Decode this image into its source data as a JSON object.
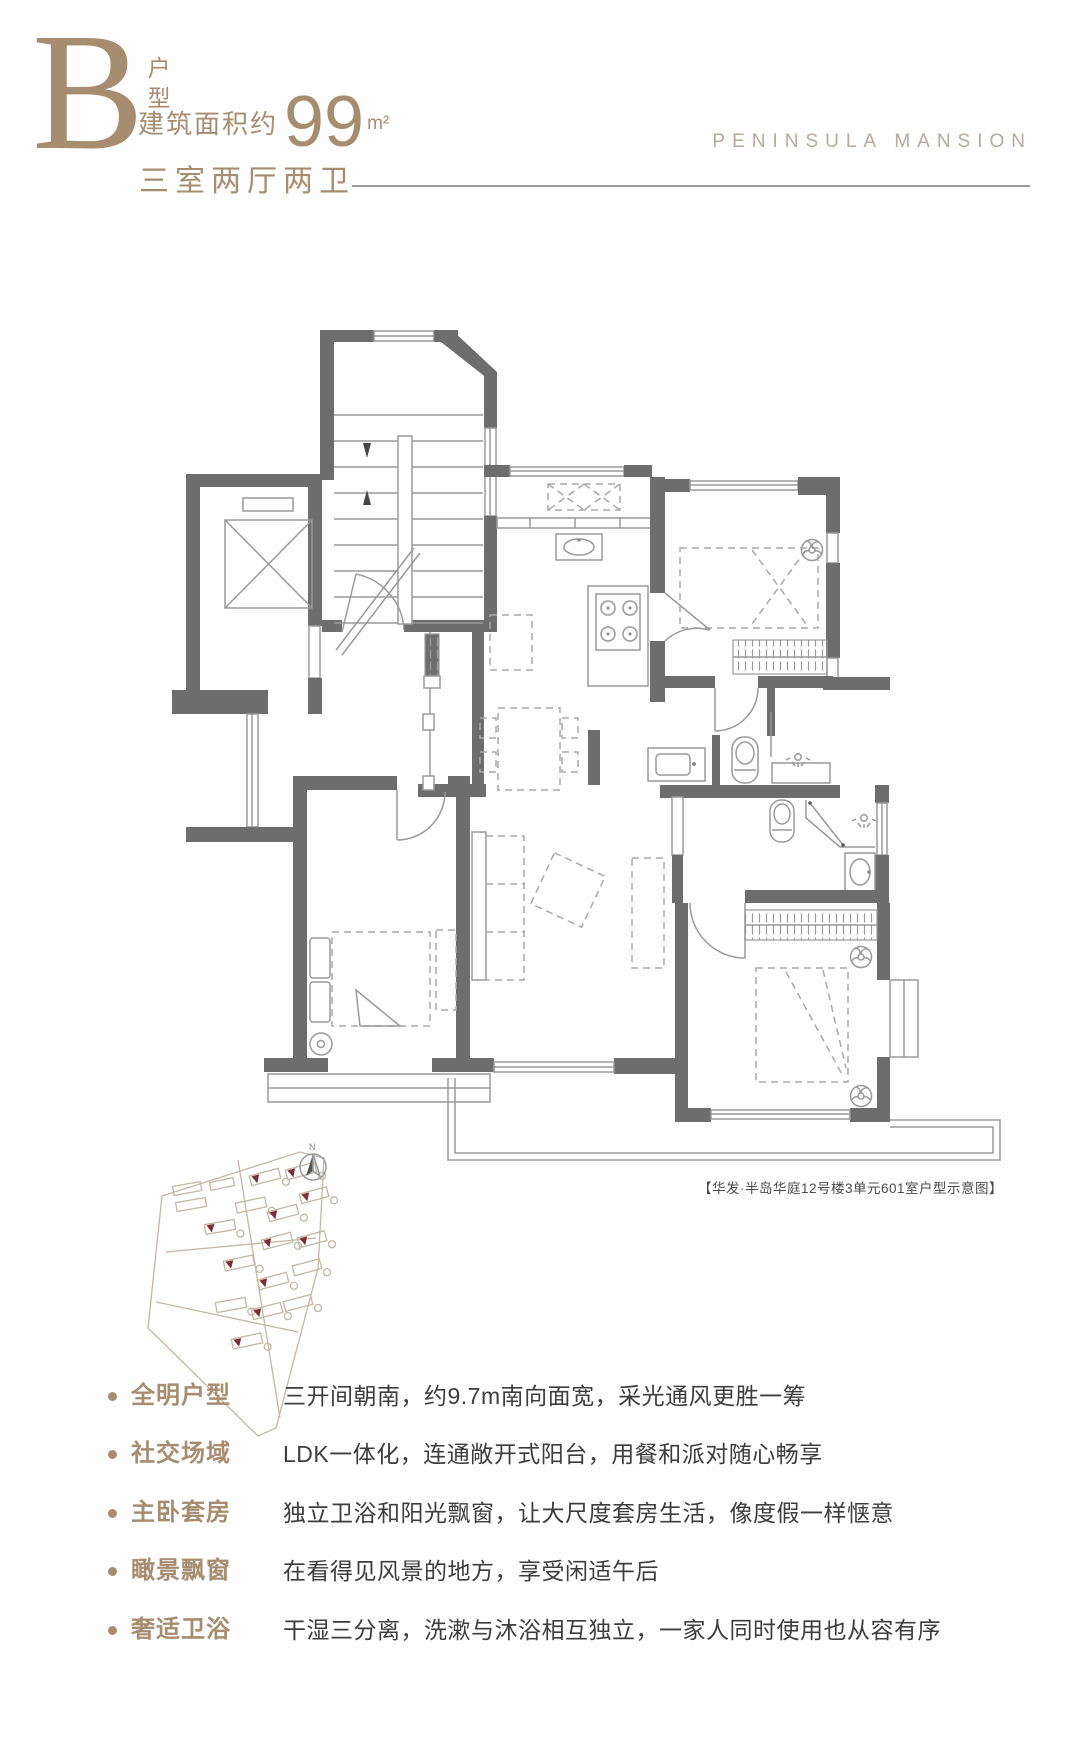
{
  "header": {
    "letter": "B",
    "unit_type": "户型",
    "area_prefix": "建筑面积约",
    "area_number": "99",
    "area_unit": "m²",
    "layout_text": "三室两厅两卫",
    "brand": "PENINSULA MANSION"
  },
  "floorplan": {
    "caption": "【华发·半岛华庭12号楼3单元601室户型示意图】",
    "compass_label": "N"
  },
  "features": {
    "items": [
      {
        "label": "全明户型",
        "desc": "三开间朝南，约9.7m南向面宽，采光通风更胜一筹"
      },
      {
        "label": "社交场域",
        "desc": "LDK一体化，连通敞开式阳台，用餐和派对随心畅享"
      },
      {
        "label": "主卧套房",
        "desc": "独立卫浴和阳光飘窗，让大尺度套房生活，像度假一样惬意"
      },
      {
        "label": "瞰景飘窗",
        "desc": "在看得见风景的地方，享受闲适午后"
      },
      {
        "label": "奢适卫浴",
        "desc": "干湿三分离，洗漱与沐浴相互独立，一家人同时使用也从容有序"
      }
    ]
  },
  "colors": {
    "gold": "#a78d6f",
    "brand_gray": "#b3aaa0",
    "wall": "#6d6d6d",
    "line": "#9a9a9a",
    "text_dark": "#3d3d3d",
    "marker_maroon": "#7b2f3a"
  }
}
